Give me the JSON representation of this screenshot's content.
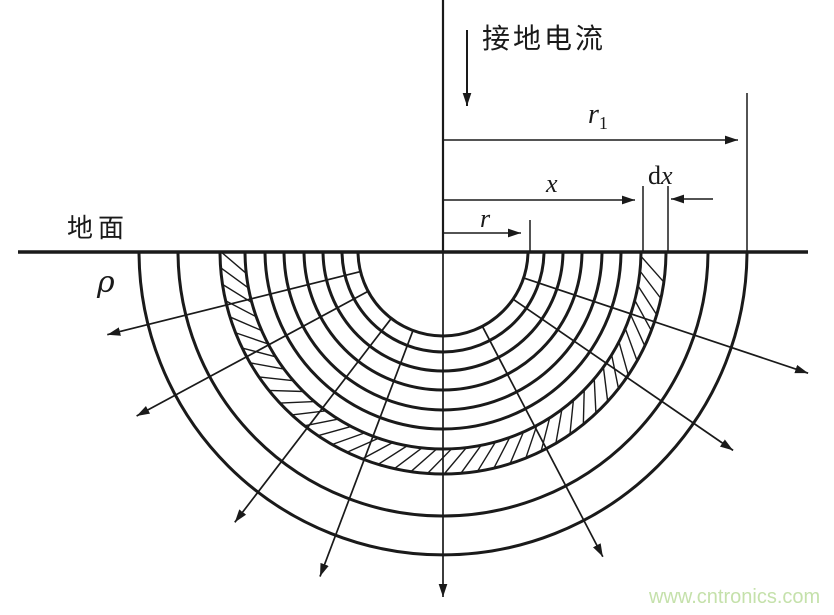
{
  "labels": {
    "grounding_current": "接地电流",
    "ground_surface": "地面",
    "resistivity": "ρ",
    "r1": {
      "base": "r",
      "sub": "1"
    },
    "x": "x",
    "dx": {
      "d": "d",
      "x": "x"
    },
    "r": "r",
    "watermark": "www.cntronics.com"
  },
  "colors": {
    "line": "#1a1a1a",
    "watermark": "#c5e1ab",
    "background": "#ffffff"
  },
  "diagram": {
    "center_x": 443,
    "ground_y": 251,
    "radii": [
      85,
      101,
      120,
      139,
      159,
      178,
      198,
      223,
      265,
      304
    ],
    "hatch_band": {
      "inner_radius": 198,
      "outer_radius": 223,
      "step_deg": 4.3,
      "skew_deg": 6.5
    },
    "spokes": [
      {
        "angle_deg": 166.0,
        "start_r": 85,
        "end_r": 346
      },
      {
        "angle_deg": 151.7,
        "start_r": 85,
        "end_r": 348
      },
      {
        "angle_deg": 127.5,
        "start_r": 85,
        "end_r": 342
      },
      {
        "angle_deg": 110.7,
        "start_r": 85,
        "end_r": 348
      },
      {
        "angle_deg": 90.0,
        "start_r": 0,
        "end_r": 346
      },
      {
        "angle_deg": 62.4,
        "start_r": 85,
        "end_r": 345
      },
      {
        "angle_deg": 34.5,
        "start_r": 85,
        "end_r": 352
      },
      {
        "angle_deg": 18.5,
        "start_r": 85,
        "end_r": 385
      }
    ],
    "ground_line": {
      "x0": 18,
      "x1": 808
    },
    "electrode": {
      "x": 443,
      "y_top": 0
    },
    "current_arrow": {
      "x": 467,
      "y0": 30,
      "y1": 106
    },
    "dimensions": {
      "r1": {
        "y": 140,
        "x0": 443,
        "x1": 738,
        "ext_x": 747,
        "ext_y0": 93
      },
      "x": {
        "y": 200,
        "x0": 443,
        "x1": 635,
        "ext_x": 643,
        "ext_y0": 186
      },
      "dx": {
        "y": 199,
        "arrow_x0": 713,
        "arrow_x1": 671,
        "ext_x": 668,
        "ext_y0": 186
      },
      "r": {
        "y": 233,
        "x0": 443,
        "x1": 521,
        "ext_x": 530,
        "ext_y0": 220
      }
    }
  }
}
